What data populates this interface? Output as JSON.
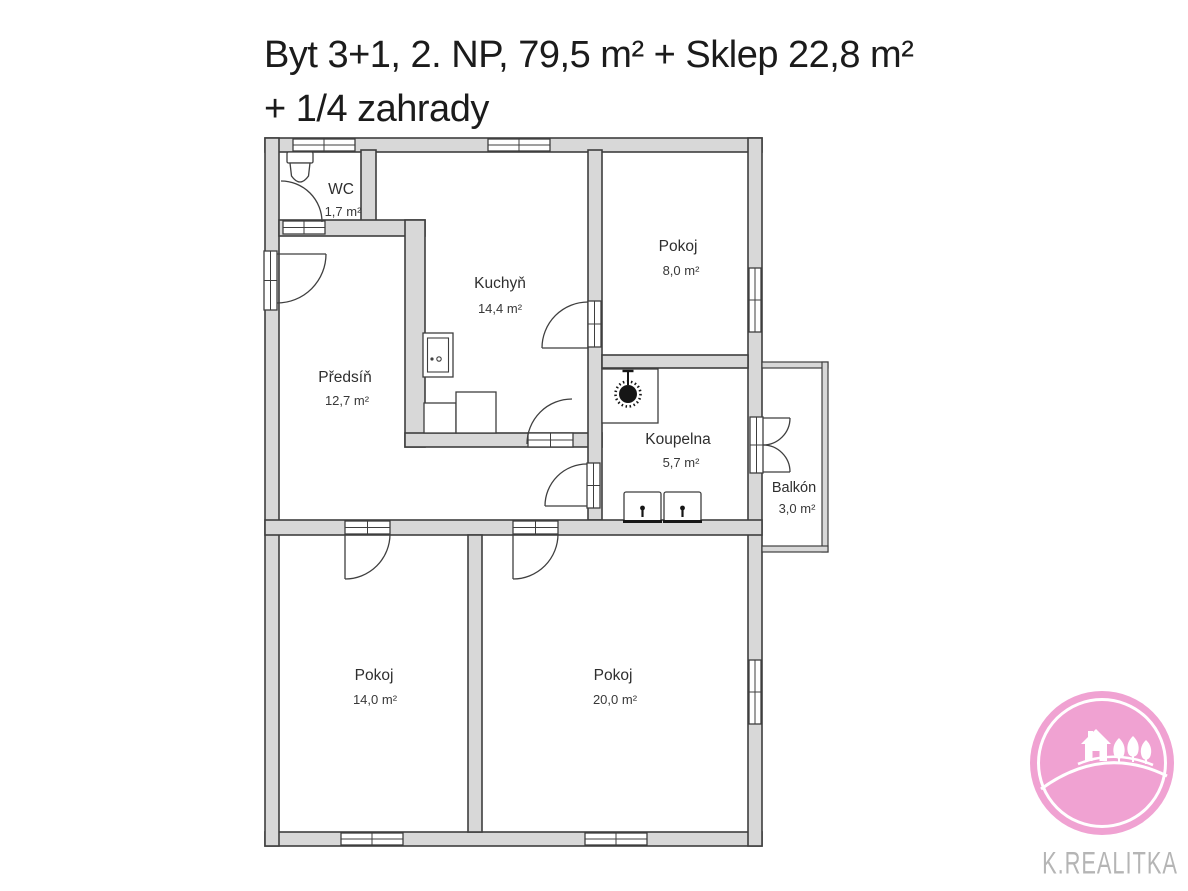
{
  "title": {
    "line1": "Byt 3+1, 2. NP, 79,5 m² + Sklep 22,8 m²",
    "line2": "+ 1/4 zahrady"
  },
  "floorplan": {
    "rooms": [
      {
        "id": "wc",
        "name": "WC",
        "area": "1,7 m²"
      },
      {
        "id": "kuchyn",
        "name": "Kuchyň",
        "area": "14,4 m²"
      },
      {
        "id": "pokoj-8",
        "name": "Pokoj",
        "area": "8,0 m²"
      },
      {
        "id": "predsin",
        "name": "Předsíň",
        "area": "12,7 m²"
      },
      {
        "id": "koupelna",
        "name": "Koupelna",
        "area": "5,7 m²"
      },
      {
        "id": "balkon",
        "name": "Balkón",
        "area": "3,0 m²"
      },
      {
        "id": "pokoj-14",
        "name": "Pokoj",
        "area": "14,0 m²"
      },
      {
        "id": "pokoj-20",
        "name": "Pokoj",
        "area": "20,0 m²"
      }
    ],
    "fixtures": [
      "toilet-icon",
      "stove-icon",
      "kitchen-counter",
      "shower-icon",
      "sink-icon",
      "sink-icon"
    ],
    "colors": {
      "wall_fill": "#d8d8d8",
      "line": "#3f3f3f"
    }
  },
  "logo": {
    "text": "K.REALITKA",
    "circle_color": "#f0a2d2",
    "text_color": "#b5b5b5",
    "artwork": [
      "house-icon",
      "tree-icon",
      "hill-lines"
    ]
  }
}
